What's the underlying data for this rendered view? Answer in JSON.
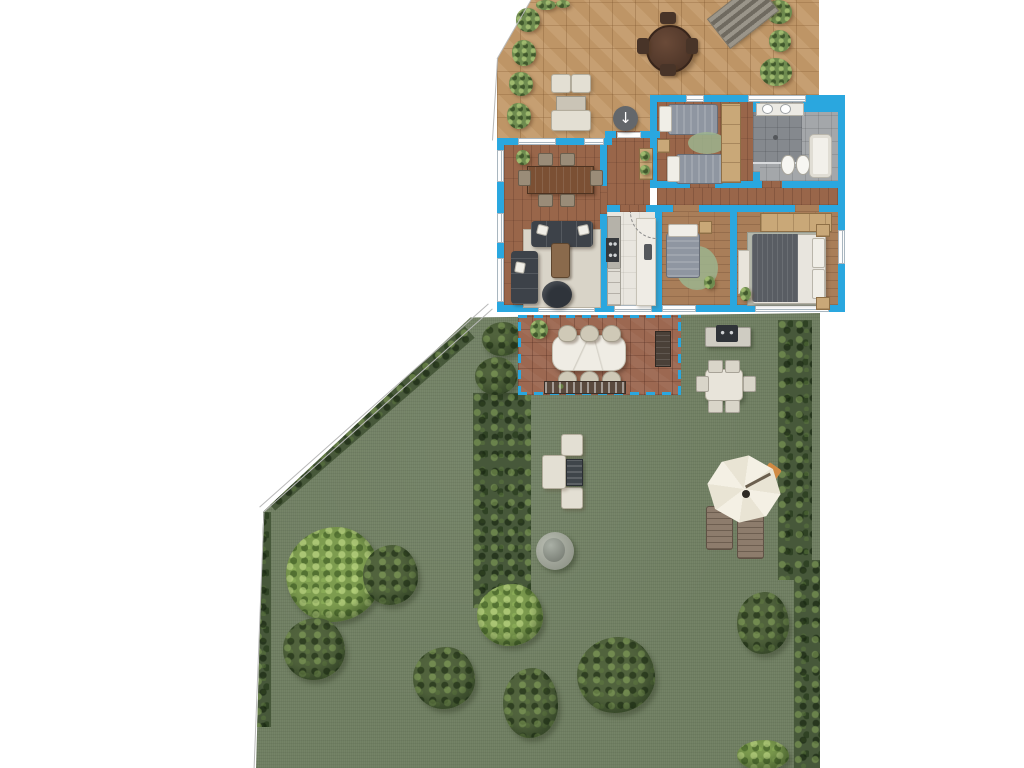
{
  "scene": {
    "type": "floor-plan-rendering",
    "description": "Top-down architectural rendering of an apartment with a tiled roof terrace, a covered brick patio and a large private garden",
    "regions": [
      "upper-terrace",
      "apartment",
      "patio",
      "garden"
    ],
    "apartment_rooms": [
      "dining-living-room",
      "kitchen",
      "entrance-hall",
      "corridor",
      "twin-bedroom",
      "bathroom",
      "bedroom",
      "master-bedroom"
    ],
    "upper_terrace_features": [
      "round-dining-table",
      "lounge-set",
      "potted-plants",
      "staircase",
      "entrance-door"
    ],
    "patio_features": [
      "marble-dining-table",
      "wicker-chairs",
      "planter-box",
      "bench",
      "pergola-dashed-outline"
    ],
    "garden_features": [
      "lawn",
      "boundary-hedges",
      "large-tree",
      "shrubs",
      "lounge-set",
      "stone-urn",
      "barbecue-grill",
      "outdoor-dining-set",
      "parasol",
      "sun-loungers"
    ]
  },
  "icons": {
    "entrance_arrow": "↓"
  },
  "palette": {
    "wall": "#2aa7df",
    "tile": "#c39a6a",
    "brick": "#9c6851",
    "parquet": "#99664a",
    "parquetlight": "#a97e59",
    "kitchen": "#e9e6df",
    "bath": "#a4a7aa",
    "grass": "#6f7e61",
    "hedge": "#47583a",
    "shrub": "#51633d",
    "tree": "#7d9c4f",
    "cream": "#e3dfd3",
    "cabinet": "#c9a878",
    "duvet": "#8f96a1",
    "sofa": "#3d4249",
    "wood": "#7b5034",
    "ruggreen": "#9cb48e",
    "rugbeige": "#d9d4c8",
    "umbrella": "#f4f0e4",
    "towel": "#d08a43",
    "lounger": "#8d7c6c",
    "marble": "#efece4",
    "planter": "#5a4a3e",
    "line": "#b9b9b9"
  }
}
